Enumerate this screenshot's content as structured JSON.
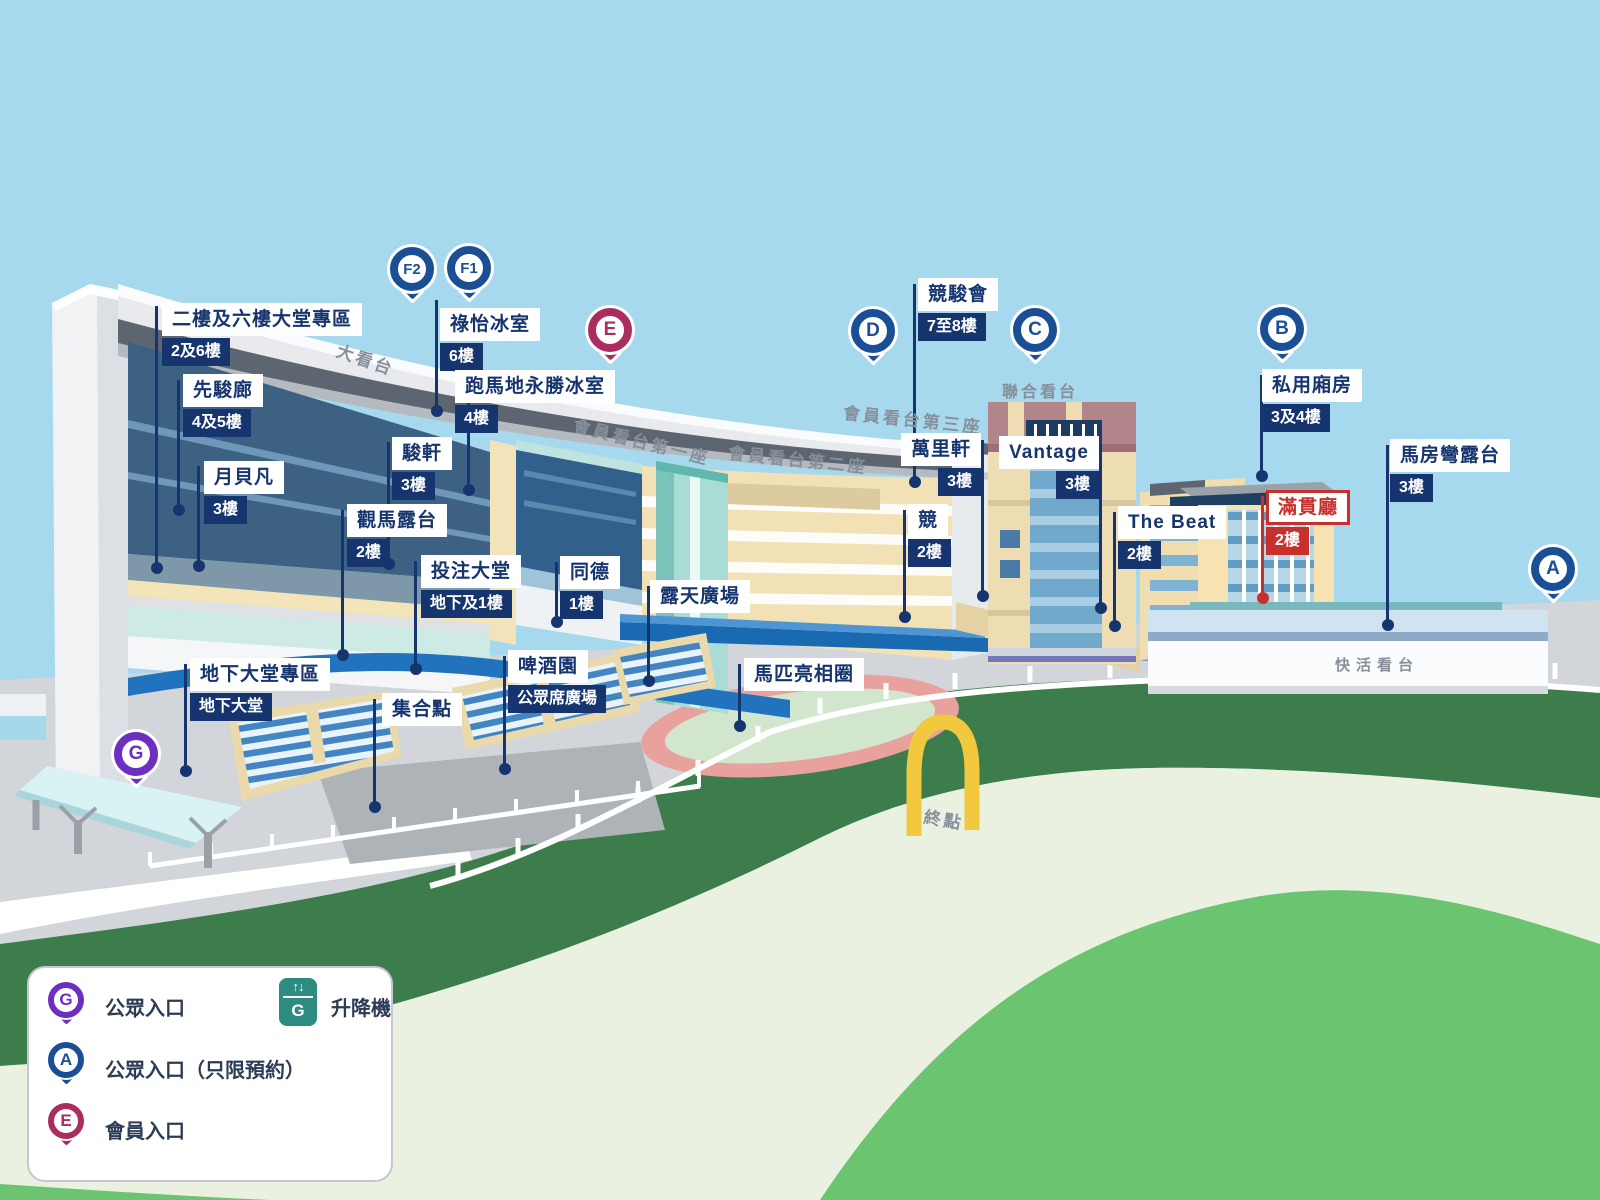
{
  "callouts": [
    {
      "title": "二樓及六樓大堂專區",
      "floor": "2及6樓"
    },
    {
      "title": "先駿廊",
      "floor": "4及5樓"
    },
    {
      "title": "月貝凡",
      "floor": "3樓"
    },
    {
      "title": "祿怡冰室",
      "floor": "6樓"
    },
    {
      "title": "跑馬地永勝冰室",
      "floor": "4樓"
    },
    {
      "title": "駿軒",
      "floor": "3樓"
    },
    {
      "title": "觀馬露台",
      "floor": "2樓"
    },
    {
      "title": "投注大堂",
      "floor": "地下及1樓"
    },
    {
      "title": "同德",
      "floor": "1樓"
    },
    {
      "title": "露天廣場",
      "floor": ""
    },
    {
      "title": "地下大堂專區",
      "floor": "地下大堂"
    },
    {
      "title": "集合點",
      "floor": ""
    },
    {
      "title": "啤酒園",
      "floor": "公眾席廣場"
    },
    {
      "title": "馬匹亮相圈",
      "floor": ""
    },
    {
      "title": "競駿會",
      "floor": "7至8樓"
    },
    {
      "title": "萬里軒",
      "floor": "3樓"
    },
    {
      "title": "競",
      "floor": "2樓"
    },
    {
      "title": "Vantage",
      "floor": "3樓"
    },
    {
      "title": "The Beat",
      "floor": "2樓"
    },
    {
      "title": "私用廂房",
      "floor": "3及4樓"
    },
    {
      "title": "滿貫廳",
      "floor": "2樓"
    },
    {
      "title": "馬房彎露台",
      "floor": "3樓"
    }
  ],
  "pins": {
    "f2": "F2",
    "f1": "F1",
    "e": "E",
    "d": "D",
    "c": "C",
    "b": "B",
    "a": "A",
    "g": "G"
  },
  "annotations": {
    "grandstand": "大看台",
    "members1": "會員看台第一座",
    "members2": "會員看台第二座",
    "members3": "會員看台第三座",
    "union": "聯合看台",
    "happy": "快活看台",
    "finish": "終點"
  },
  "legend": {
    "public_entrance": "公眾入口",
    "public_entrance_reserved": "公眾入口（只限預約）",
    "members_entrance": "會員入口",
    "lift": "升降機",
    "lift_letter": "G",
    "lift_arrows": "↑↓"
  },
  "colors": {
    "navy": "#16356e",
    "red": "#c8302d",
    "pin_blue": "#1a4f96",
    "purple": "#6d2fc0",
    "crimson": "#a92d5f",
    "lift_teal": "#2d8b7f",
    "sky": "#a6d9ee",
    "track_green": "#3c7d4b",
    "infield_green": "#ebf1e1",
    "lawn_green": "#6ac470",
    "arch_yellow": "#f2c83f"
  }
}
